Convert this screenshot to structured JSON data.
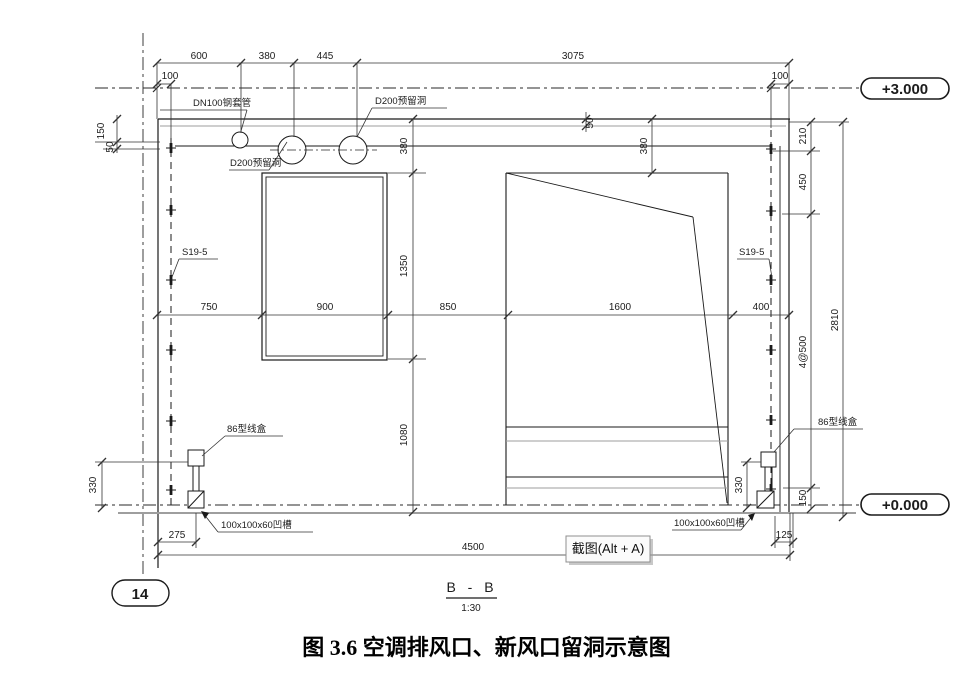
{
  "drawing": {
    "elevations": {
      "top": "+3.000",
      "bottom": "+0.000"
    },
    "grid": {
      "bubble": "14"
    },
    "section": {
      "title": "B - B",
      "scale": "1:30"
    },
    "screenshot_button": {
      "label": "截图(Alt + A)"
    },
    "caption": "图 3.6 空调排风口、新风口留洞示意图",
    "labels": {
      "dn100": "DN100钢套管",
      "d200_top": "D200预留洞",
      "d200_bottom": "D200预留洞",
      "s19_left": "S19-5",
      "s19_right": "S19-5",
      "box_left": "86型线盒",
      "box_right": "86型线盒",
      "recess_left": "100x100x60凹槽",
      "recess_right": "100x100x60凹槽"
    },
    "dims": {
      "d600": "600",
      "d380t": "380",
      "d445": "445",
      "d3075": "3075",
      "d100l": "100",
      "d100r": "100",
      "d150l": "150",
      "d50l": "50",
      "d50m": "50",
      "d380m": "380",
      "d380r": "380",
      "d1350": "1350",
      "d1080": "1080",
      "d750": "750",
      "d900": "900",
      "d850": "850",
      "d1600": "1600",
      "d400": "400",
      "d210": "210",
      "d450": "450",
      "d4at500": "4@500",
      "d150r": "150",
      "d2810": "2810",
      "d330l": "330",
      "d330r": "330",
      "d275": "275",
      "d125": "125",
      "d4500": "4500"
    }
  }
}
